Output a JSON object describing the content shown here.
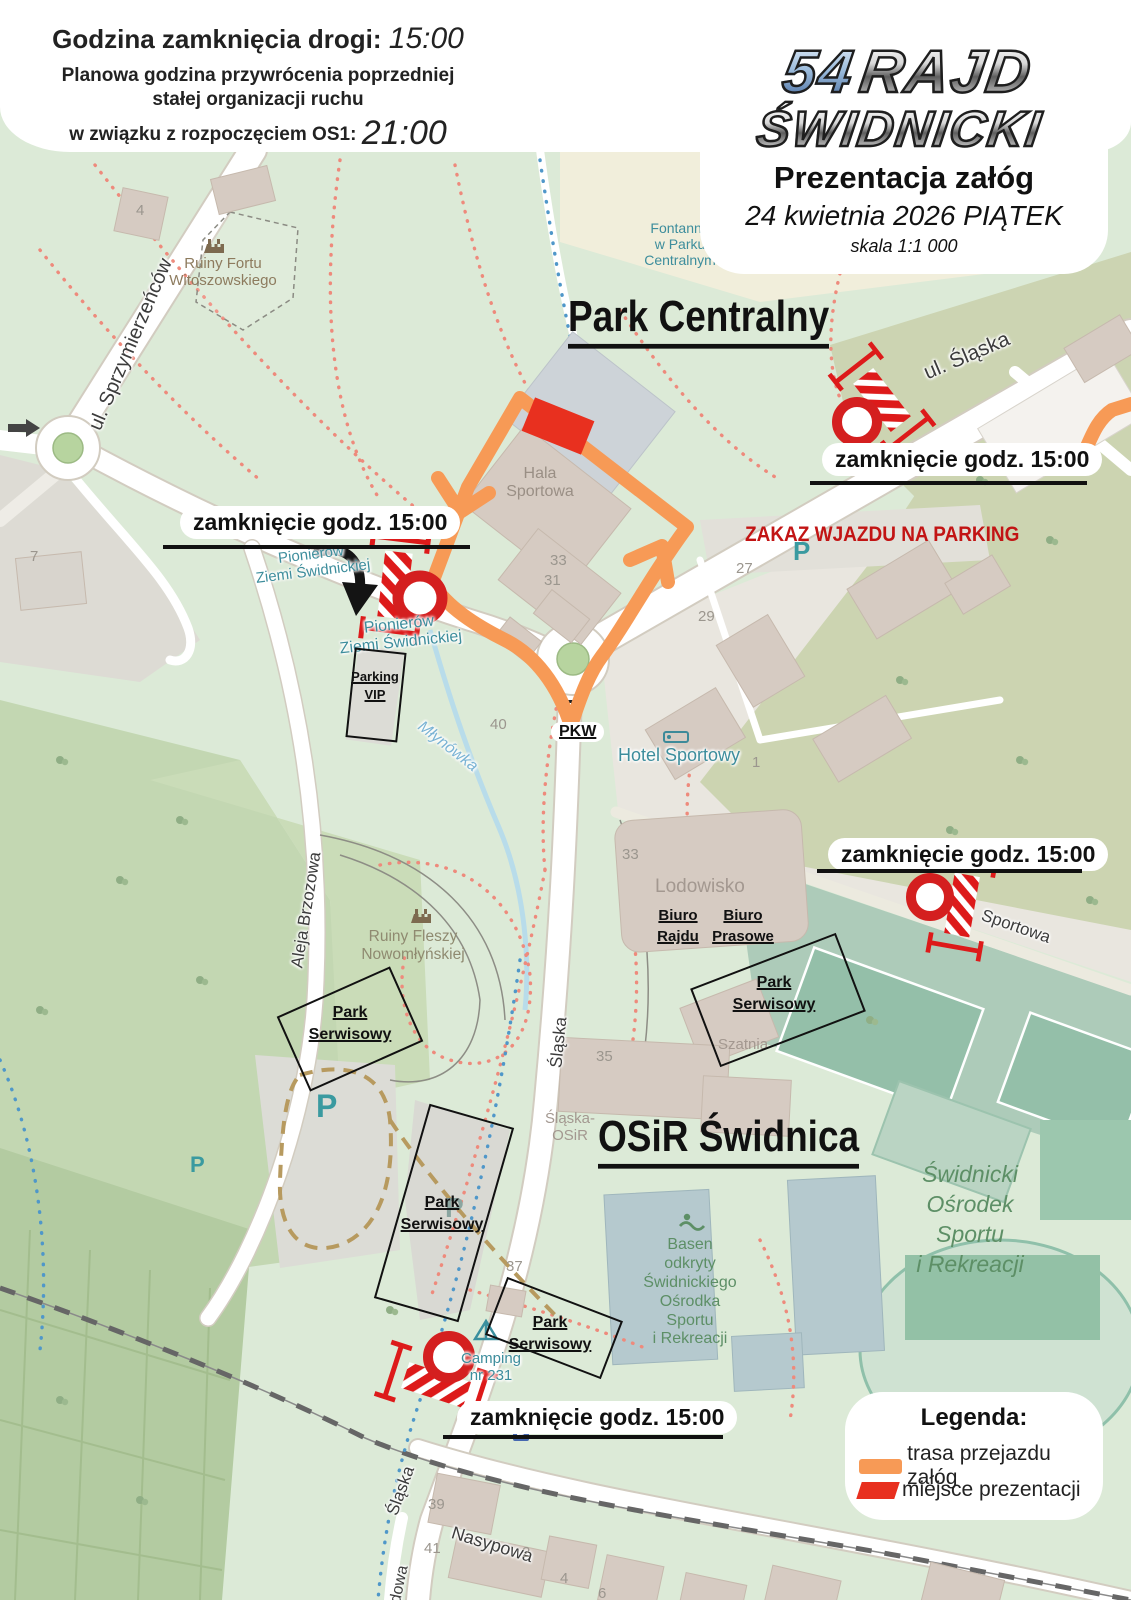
{
  "header": {
    "closure_label": "Godzina zamknięcia drogi:",
    "closure_time": "15:00",
    "restore_line1": "Planowa godzina przywrócenia poprzedniej",
    "restore_line2": "stałej organizacji ruchu",
    "restore_line3": "w związku z rozpoczęciem OS1:",
    "restore_time": "21:00"
  },
  "event_card": {
    "number": "54",
    "word1": "RAJD",
    "word2": "ŚWIDNICKI",
    "subtitle": "Prezentacja załóg",
    "date": "24 kwietnia 2026 PIĄTEK",
    "scale": "skala 1:1 000"
  },
  "annotations": {
    "closure_text": "zamknięcie godz. 15:00",
    "zakaz": "ZAKAZ WJAZDU NA PARKING",
    "pkw": "PKW",
    "parking_vip": {
      "line1": "Parking",
      "line2": "VIP"
    },
    "park_serwisowy": {
      "line1": "Park",
      "line2": "Serwisowy"
    },
    "biuro_rajdu": {
      "line1": "Biuro",
      "line2": "Rajdu"
    },
    "biuro_prasowe": {
      "line1": "Biuro",
      "line2": "Prasowe"
    }
  },
  "areas": {
    "park_centralny": "Park Centralny",
    "osir": "OSiR Świdnica"
  },
  "map_labels": {
    "streets": {
      "ul_slaska": "ul. Śląska",
      "sprzymierzencow": "ul. Sprzymierzeńców",
      "aleja_brzozowa": "Aleja Brzozowa",
      "sportowa": "Sportowa",
      "slaska_mid": "Śląska",
      "slaska_bottom": "Śląska",
      "nasypowa": "Nasypowa",
      "dowa": "dowa",
      "pionierow1_l1": "Pionierów",
      "pionierow1_l2": "Ziemi Świdnickiej",
      "pionierow2_l1": "Pionierów",
      "pionierow2_l2": "Ziemi Świdnickiej",
      "mlynowka": "Młynówka"
    },
    "places": {
      "hala_l1": "Hala",
      "hala_l2": "Sportowa",
      "hotel": "Hotel Sportowy",
      "lodowisko": "Lodowisko",
      "szatnia": "Szatnia",
      "slaska_osir_l1": "Śląska-",
      "slaska_osir_l2": "OSiR",
      "fort_l1": "Ruiny Fortu",
      "fort_l2": "Witoszowskiego",
      "fleszy_l1": "Ruiny Fleszy",
      "fleszy_l2": "Nowomłyńskiej",
      "fontanna_l1": "Fontanna",
      "fontanna_l2": "w Parku",
      "fontanna_l3": "Centralnym",
      "camping_l1": "Camping",
      "camping_l2": "nr 231",
      "basen": [
        "Basen",
        "odkryty",
        "Świdnickiego",
        "Ośrodka",
        "Sportu",
        "i Rekreacji"
      ],
      "osrodek": [
        "Świdnicki",
        "Ośrodek",
        "Sportu",
        "i Rekreacji"
      ],
      "parking_p": "P"
    },
    "numbers": {
      "n4": "4",
      "n7": "7",
      "n33a": "33",
      "n31": "31",
      "n27": "27",
      "n29": "29",
      "n40": "40",
      "n1": "1",
      "n33b": "33",
      "n35": "35",
      "n37": "37",
      "n39": "39",
      "n41": "41",
      "n2": "2",
      "n4b": "4",
      "n6": "6"
    }
  },
  "legend": {
    "title": "Legenda:",
    "route": "trasa przejazdu załóg",
    "presentation": "miejsce prezentacji"
  },
  "colors": {
    "route_orange": "#F79A56",
    "presentation_red": "#E8301F",
    "closure_red": "#D41F1F",
    "zakaz_text_red": "#C21414"
  }
}
